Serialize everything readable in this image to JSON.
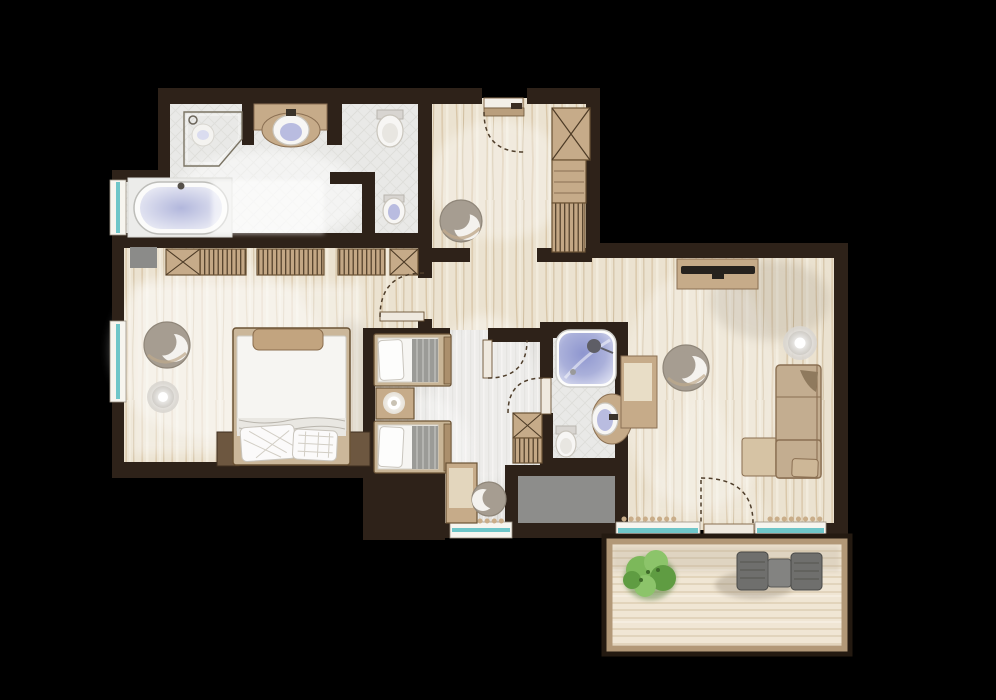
{
  "meta": {
    "title": "apartment-suite-floor-plan",
    "view": "top-down architectural floor plan rendering",
    "background": "#000000",
    "visible_text": "none"
  },
  "palette": {
    "wall": "#2e2219",
    "wood_base": "#ebe2d0",
    "tile_base": "#e9e9e7",
    "carpet_base": "#e4e3e0",
    "deck_base": "#f0e6d4",
    "window_glass": "#6fc6c9",
    "window_frame": "#f7f5ef",
    "furniture_tan": "#c6ab89",
    "furniture_tan_dark": "#8a6f52",
    "sofa_beige": "#c3ad90",
    "chair_taupe": "#a69d91",
    "fixture_white": "#f7f6f4",
    "water_blue": "#8e96cf",
    "shaft_gray": "#8d8d8b",
    "plant_green": "#7cb85a",
    "outdoor_gray": "#6f6f6d",
    "lamp_glow": "#ffffff"
  },
  "rooms": [
    {
      "id": "master-bathroom",
      "floor": "tile",
      "fixtures": [
        "corner-shower",
        "vanity-sink",
        "toilet",
        "bidet-wc-nook",
        "freestanding-bathtub",
        "window"
      ]
    },
    {
      "id": "entry-hall",
      "floor": "wood",
      "fixtures": [
        "entrance-door",
        "closet-cabinet",
        "closet-shelves",
        "closet-rail",
        "armchair"
      ]
    },
    {
      "id": "master-bedroom",
      "floor": "wood",
      "fixtures": [
        "double-bed",
        "foot-bench",
        "nightstand-left",
        "nightstand-right",
        "wardrobe-row",
        "armchair",
        "floor-lamp",
        "stool",
        "window",
        "rug"
      ]
    },
    {
      "id": "twin-bedroom",
      "floor": "carpet",
      "fixtures": [
        "twin-bed-1",
        "twin-bed-2",
        "nightstand-lamp",
        "desk",
        "desk-chair",
        "window"
      ]
    },
    {
      "id": "corridor",
      "floor": "wood-carpet",
      "fixtures": [
        "corridor-wardrobe",
        "doors"
      ]
    },
    {
      "id": "second-bathroom",
      "floor": "tile",
      "fixtures": [
        "shower",
        "washbasin",
        "toilet"
      ]
    },
    {
      "id": "living-room",
      "floor": "wood",
      "fixtures": [
        "tv-sideboard",
        "desk",
        "armchair",
        "floor-lamp",
        "corner-sofa",
        "ottoman",
        "balcony-door",
        "window-1",
        "window-2",
        "plant-strips"
      ]
    },
    {
      "id": "shaft",
      "floor": "gray",
      "fixtures": []
    },
    {
      "id": "balcony",
      "floor": "deck",
      "fixtures": [
        "plant",
        "lounge-chair-1",
        "side-table",
        "lounge-chair-2",
        "railing"
      ]
    }
  ]
}
